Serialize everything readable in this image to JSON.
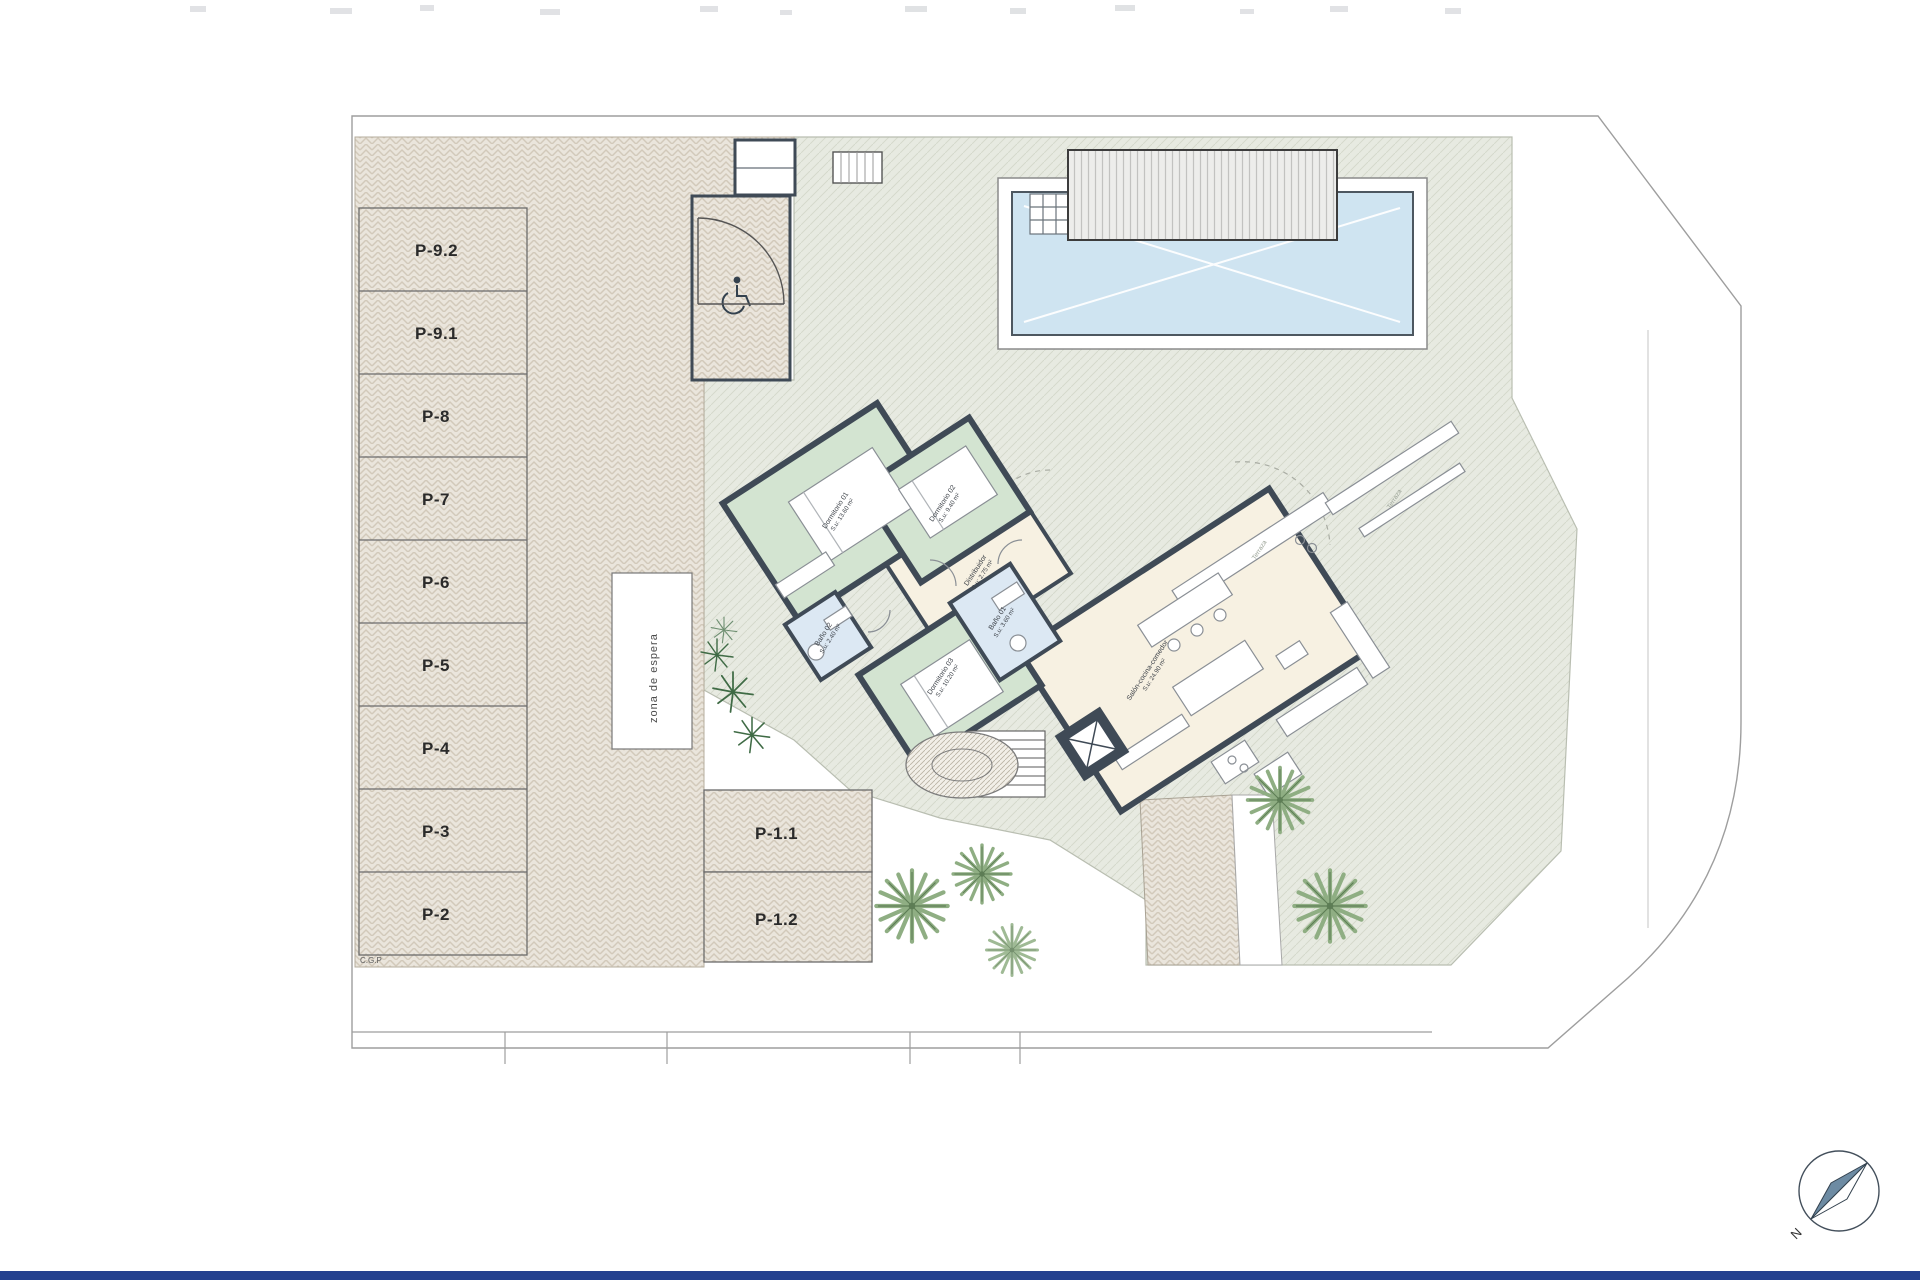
{
  "parking": {
    "stalls": [
      "P-9.2",
      "P-9.1",
      "P-8",
      "P-7",
      "P-6",
      "P-5",
      "P-4",
      "P-3",
      "P-2"
    ],
    "front_stalls": [
      "P-1.1",
      "P-1.2"
    ],
    "waiting_zone_label": "zona de espera",
    "cgp_label": "C.G.P"
  },
  "house": {
    "rooms": [
      {
        "id": "dormitorio-01",
        "name": "Dormitorio 01",
        "area": "S.u: 13.60 m²"
      },
      {
        "id": "dormitorio-02",
        "name": "Dormitorio 02",
        "area": "S.u: 9.40 m²"
      },
      {
        "id": "dormitorio-03",
        "name": "Dormitorio 03",
        "area": "S.u: 10.20 m²"
      },
      {
        "id": "bano-01",
        "name": "Baño 01",
        "area": "S.u: 3.60 m²"
      },
      {
        "id": "bano-02",
        "name": "Baño 02",
        "area": "S.u: 2.40 m²"
      },
      {
        "id": "distribuidor",
        "name": "Distribuidor",
        "area": "S.u: 2.75 m²"
      },
      {
        "id": "salon",
        "name": "Salón-cocina-comedor",
        "area": "S.u: 24.90 m²"
      }
    ]
  },
  "site": {
    "terrace_label_1": "Terraza",
    "terrace_label_2": "Terraza",
    "compass_north": "N"
  },
  "colors": {
    "wall": "#3f4a56",
    "bedroom_floor": "#d3e4d1",
    "bath_floor": "#dce8f3",
    "living_floor": "#f7f1e2",
    "terrace": "#e7eae1",
    "parking_fill": "#eae5dc",
    "pool_water": "#cfe4f1",
    "footer_bar": "#24418f"
  }
}
